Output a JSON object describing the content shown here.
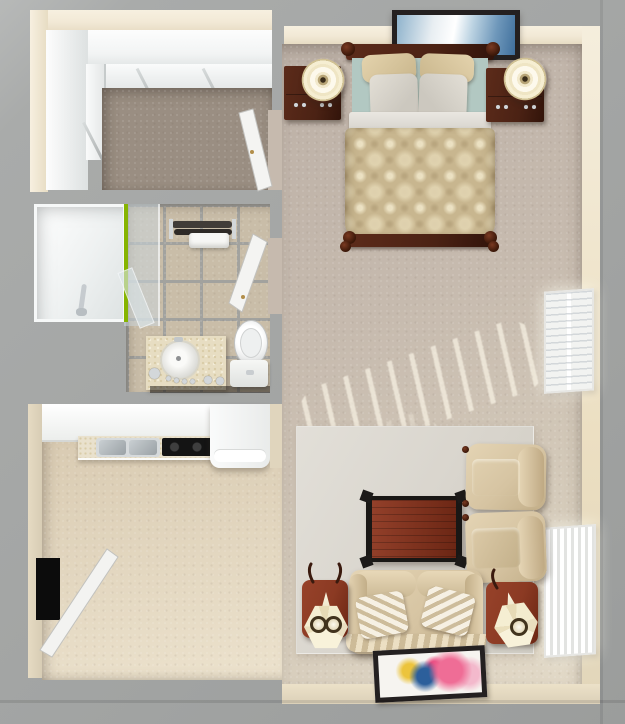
{
  "meta": {
    "width_px": 625,
    "height_px": 724
  },
  "scene": {
    "type": "apartment-floor-plan-3d-top-view",
    "rooms": [
      {
        "name": "walk-in-closet",
        "position": "top-left",
        "features": [
          "shelving",
          "carpet-floor",
          "open-door"
        ]
      },
      {
        "name": "bathroom",
        "position": "middle-left",
        "features": [
          "bathtub-shower",
          "glass-door-green-trim",
          "tile-floor",
          "towel-rack",
          "vanity-with-round-sink",
          "toilet",
          "open-door"
        ]
      },
      {
        "name": "kitchen",
        "position": "bottom-left",
        "features": [
          "upper-cabinets",
          "counter-with-double-sink",
          "black-cooktop",
          "refrigerator",
          "entry-door"
        ]
      },
      {
        "name": "main-room",
        "position": "right",
        "features": [
          "bed-with-damask-comforter",
          "two-nightstands",
          "two-round-lamps",
          "wall-art-above-bed",
          "two-windows-with-blinds",
          "area-rug",
          "coffee-table",
          "two-armchairs",
          "loveseat-with-striped-pillows",
          "two-end-tables-with-hex-lamps",
          "colorful-floor-art",
          "sunlight-streaks"
        ]
      }
    ]
  },
  "palette": {
    "bg_gray": "#a4a6a5",
    "wall_face_cream": "#f2e9d6",
    "wall_face_tan": "#e0d5bd",
    "closet_wall_white": "#f2f4f4",
    "closet_carpet": "#9a8e82",
    "tile": "#c9bda8",
    "grout": "#a2a29e",
    "glass_green": "#86b400",
    "main_carpet": "#c6baae",
    "carpet_light": "#e3dac8",
    "kitchen_floor": "#d9cbb2",
    "rug": "#d8d4cc",
    "wood_dark": "#4b2214",
    "wood_red": "#8b3a23",
    "fabric": "#d6c4a2",
    "comforter": "#c8b68f",
    "teal_sheet": "#b2c8c2",
    "lamp_cream": "#f6eed2",
    "blinds": "#fbfbfa",
    "art_blue": "#6e97ba",
    "art_frame": "#242020",
    "art_pink": "#ef6d96",
    "art_magenta": "#e8447c",
    "art_deep_blue": "#2c5f9b",
    "art_yellow": "#ecc43c",
    "entry_black": "#0c0c0c"
  }
}
